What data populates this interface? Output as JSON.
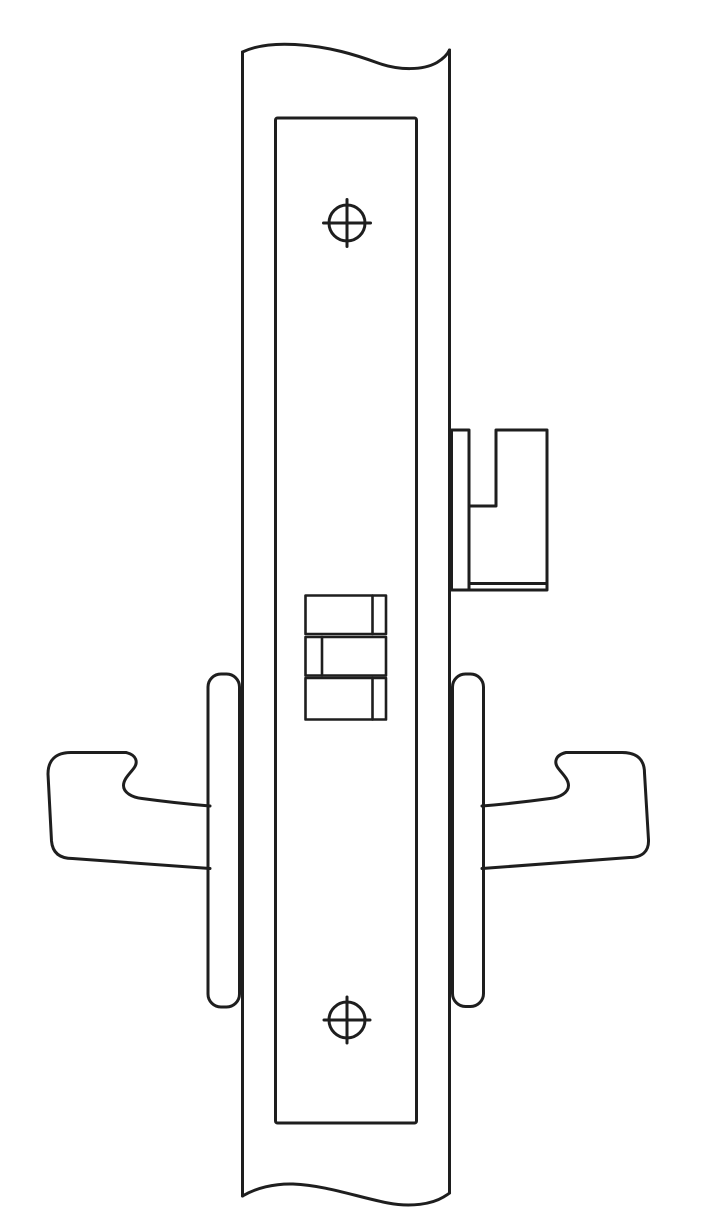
{
  "colors": {
    "line": "#1e1e1e",
    "background": "#ffffff"
  },
  "diagram": {
    "kind": "technical-line-drawing",
    "subject": "mortise-lock-door-edge-view",
    "parts": [
      "door-edge-left",
      "door-edge-right",
      "break-line-top",
      "break-line-bottom",
      "faceplate",
      "faceplate-screw-top",
      "faceplate-screw-bottom",
      "latch-bolt",
      "latch-bolt-slot",
      "bolt-hub-stack",
      "rose-left",
      "rose-right",
      "lever-handle-left",
      "lever-handle-right"
    ]
  },
  "geometry": {
    "door_left": "M242.5,52 L242.5,1196",
    "door_right": "M449.5,50 L449.5,1193",
    "break_top": "M242.5,52 C258,44.5 277,43.5 295,44.5 C330,46.5 356,55 378,63 C399,70.5 423,70.5 437,62.5 C443.5,58.5 447.5,54.5 449.5,50",
    "break_bottom": "M242.5,1196 C256,1188 274,1183.5 293,1184 C327,1185.5 357,1197 388,1203 C411,1207.5 432,1204 443.5,1197 C446.5,1195 448.5,1194 449.5,1193",
    "screw_top_h": "M323.5,223 L370.5,223",
    "screw_top_v": "M347,199.5 L347,246.5",
    "screw_bottom_h": "M324,1020 L370,1020",
    "screw_bottom_v": "M347,997 L347,1043",
    "latch_outline": "M451.5,430 L469,430 L469,506 L496,506 L496,430 L547,430 L547,590 L451.5,590 Z",
    "latch_divider": "M469,506 L469,590",
    "latch_body_bottom": "M469,583.5 L547,583.5",
    "stack_line_a": "M372.5,595.5 L372.5,634",
    "stack_line_b": "M322,637 L322,675.5",
    "stack_line_c": "M372.5,678 L372.5,719.5",
    "lever_left": "M210,806 C180,803.5 153,800 142,798.5 C132,797.5 123.5,792.5 123.5,785.5 C123.5,779 130,773.5 134,768 C138,762.5 137,755 126,752.5 L71,752.5 C55.5,752.5 48,760.5 48,774 L51.5,841 C52.5,852.5 59.5,858.5 72.5,858.5 L210,868.5",
    "lever_right": "M482,806 C512,803.5 539,800 550,798.5 C560,797.5 568.5,792.5 568.5,785.5 C568.5,779 562,773.5 558,768 C554,762.5 555,755 566,752.5 L622,752.5 C637.5,752.5 644.5,760 644.5,773 L648.5,840 C649,851.5 642,857.5 629.5,857.5 L482,868.5"
  }
}
